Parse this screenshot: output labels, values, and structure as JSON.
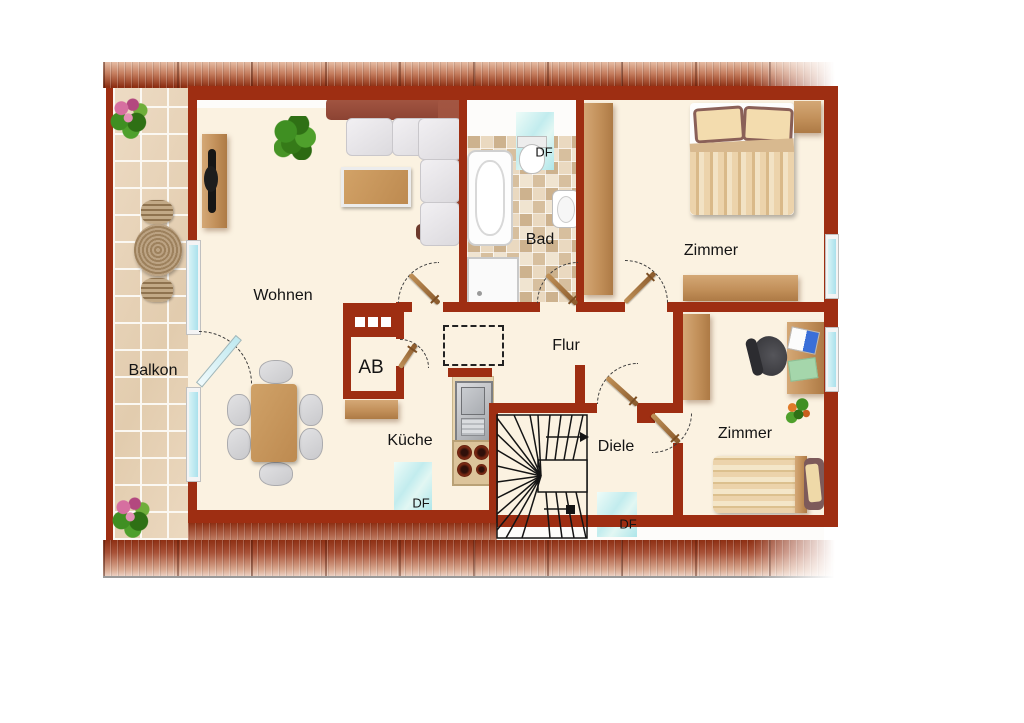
{
  "floorplan": {
    "rooms": [
      {
        "name": "balkon",
        "label": "Balkon"
      },
      {
        "name": "wohnen",
        "label": "Wohnen"
      },
      {
        "name": "bad",
        "label": "Bad"
      },
      {
        "name": "zimmer-top",
        "label": "Zimmer"
      },
      {
        "name": "flur",
        "label": "Flur"
      },
      {
        "name": "abstellraum",
        "label": "AB"
      },
      {
        "name": "kueche",
        "label": "Küche"
      },
      {
        "name": "diele",
        "label": "Diele"
      },
      {
        "name": "zimmer-bottom",
        "label": "Zimmer"
      }
    ],
    "skylights": [
      {
        "room": "bad",
        "label": "DF"
      },
      {
        "room": "kueche",
        "label": "DF"
      },
      {
        "room": "diele",
        "label": "DF"
      }
    ],
    "furniture": [
      "corner-sofa",
      "coffee-table",
      "tv-sideboard",
      "potted-plant",
      "dining-table",
      "dining-chairs",
      "balcony-table",
      "balcony-chairs",
      "flower-pots",
      "bathtub",
      "shower",
      "wash-basin",
      "toilet",
      "double-bed",
      "nightstand",
      "wardrobe",
      "sideboard",
      "single-bed",
      "desk",
      "office-chair",
      "laptop",
      "kitchen-sink",
      "stove",
      "staircase",
      "storage-cabinet"
    ],
    "colors": {
      "wall": "#9e2e12",
      "floor": "#fbf2e1",
      "roof_dark": "#8e3014",
      "roof_light": "#d9a88f",
      "balcony_tile": "#ead7bf",
      "bad_tile": "#d7bf9e",
      "glass": "#bfe9f0",
      "wood": "#c5975f",
      "sofa": "#9a4a38",
      "stair_ink": "#141414"
    }
  }
}
